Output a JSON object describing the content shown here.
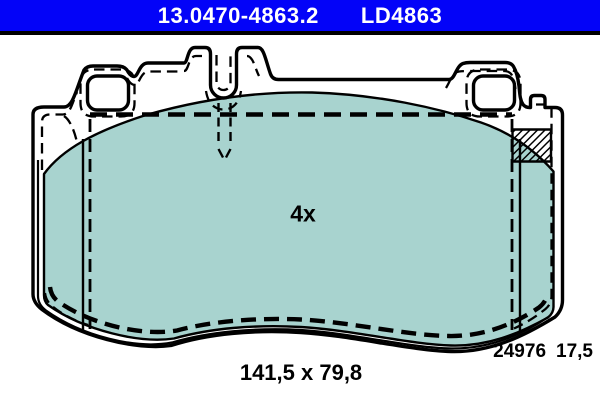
{
  "header": {
    "part_number": "13.0470-4863.2",
    "product_code": "LD4863",
    "bar_color": "#0303f8",
    "text_color": "#ffffff"
  },
  "drawing": {
    "quantity_label": "4x",
    "dimensions_label": "141,5 x 79,8",
    "drawing_number": "24976",
    "thickness": "17,5",
    "pad_color": "#a8d3cf",
    "line_color": "#000000",
    "background_color": "#ffffff"
  }
}
